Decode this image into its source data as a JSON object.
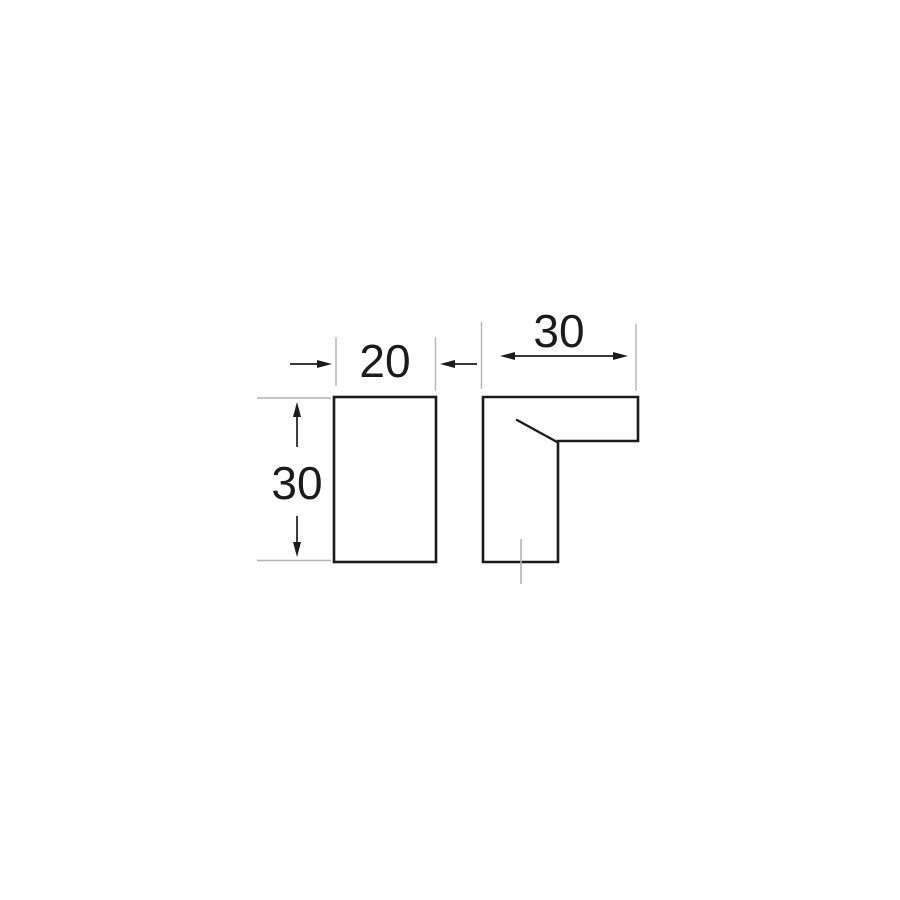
{
  "canvas": {
    "background_color": "#ffffff"
  },
  "drawing": {
    "type": "technical-dimension-drawing",
    "subject": "knob-profile-two-views",
    "outline_color": "#1b1b1b",
    "thin_line_color": "#b3b3b3",
    "text_color": "#1b1b1b",
    "views": {
      "front": {
        "shape": "rectangle",
        "width_dimension": {
          "label": "20"
        },
        "height_dimension": {
          "label": "30"
        }
      },
      "side": {
        "shape": "l-profile",
        "depth_dimension": {
          "label": "30"
        }
      }
    }
  }
}
